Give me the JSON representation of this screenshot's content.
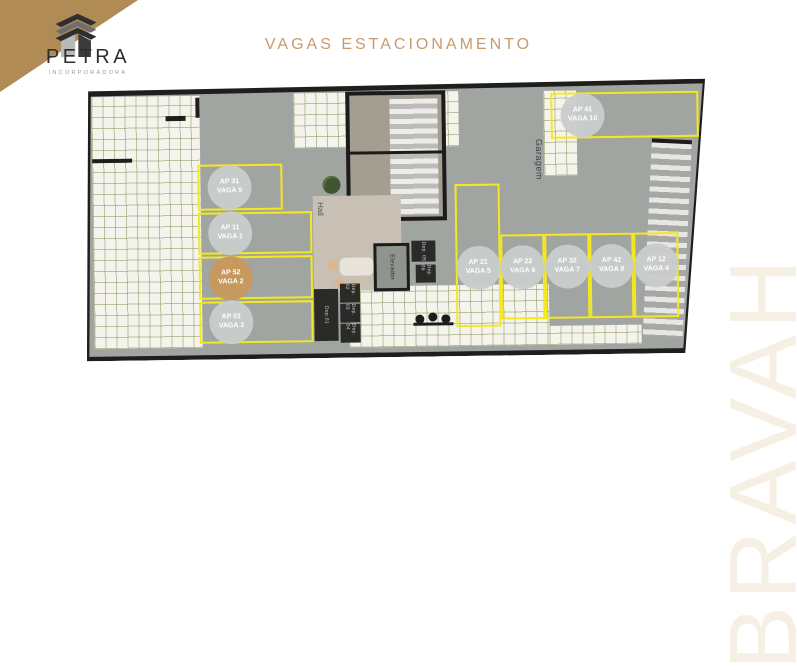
{
  "brand": {
    "name": "PETRA",
    "subtitle": "INCORPORADORA"
  },
  "title": "VAGAS ESTACIONAMENTO",
  "watermark": "BRAVAH",
  "colors": {
    "accent_gold": "#B08B55",
    "title_gold": "#C79A6E",
    "highlight_spot": "#C8995F",
    "stall_outline_yellow": "#F4E81F",
    "floor_gray": "#A0A5A2",
    "tile_grout_olive": "#8B965C",
    "wall_black": "#1E1E1C",
    "watermark_cream": "#F6F0E4"
  },
  "plan": {
    "area_labels": [
      {
        "label": "Hall"
      },
      {
        "label": "Elevador"
      },
      {
        "label": "Garagem"
      },
      {
        "label": "Dep.01"
      },
      {
        "label": "Dep. 02"
      },
      {
        "label": "Dep. 03"
      },
      {
        "label": "Dep. 04"
      },
      {
        "label": "Dep. 05"
      },
      {
        "label": "Dep. 06"
      }
    ],
    "stalls": [
      {
        "ap": "AP 31",
        "vaga": "VAGA 9",
        "highlighted": false
      },
      {
        "ap": "AP 11",
        "vaga": "VAGA 1",
        "highlighted": false
      },
      {
        "ap": "AP 52",
        "vaga": "VAGA 2",
        "highlighted": true
      },
      {
        "ap": "AP 51",
        "vaga": "VAGA 3",
        "highlighted": false
      },
      {
        "ap": "AP 21",
        "vaga": "VAGA 5",
        "highlighted": false
      },
      {
        "ap": "AP 22",
        "vaga": "VAGA 6",
        "highlighted": false
      },
      {
        "ap": "AP 32",
        "vaga": "VAGA 7",
        "highlighted": false
      },
      {
        "ap": "AP 42",
        "vaga": "VAGA 8",
        "highlighted": false
      },
      {
        "ap": "AP 12",
        "vaga": "VAGA 4",
        "highlighted": false
      },
      {
        "ap": "AP 41",
        "vaga": "VAGA 10",
        "highlighted": false
      }
    ]
  }
}
